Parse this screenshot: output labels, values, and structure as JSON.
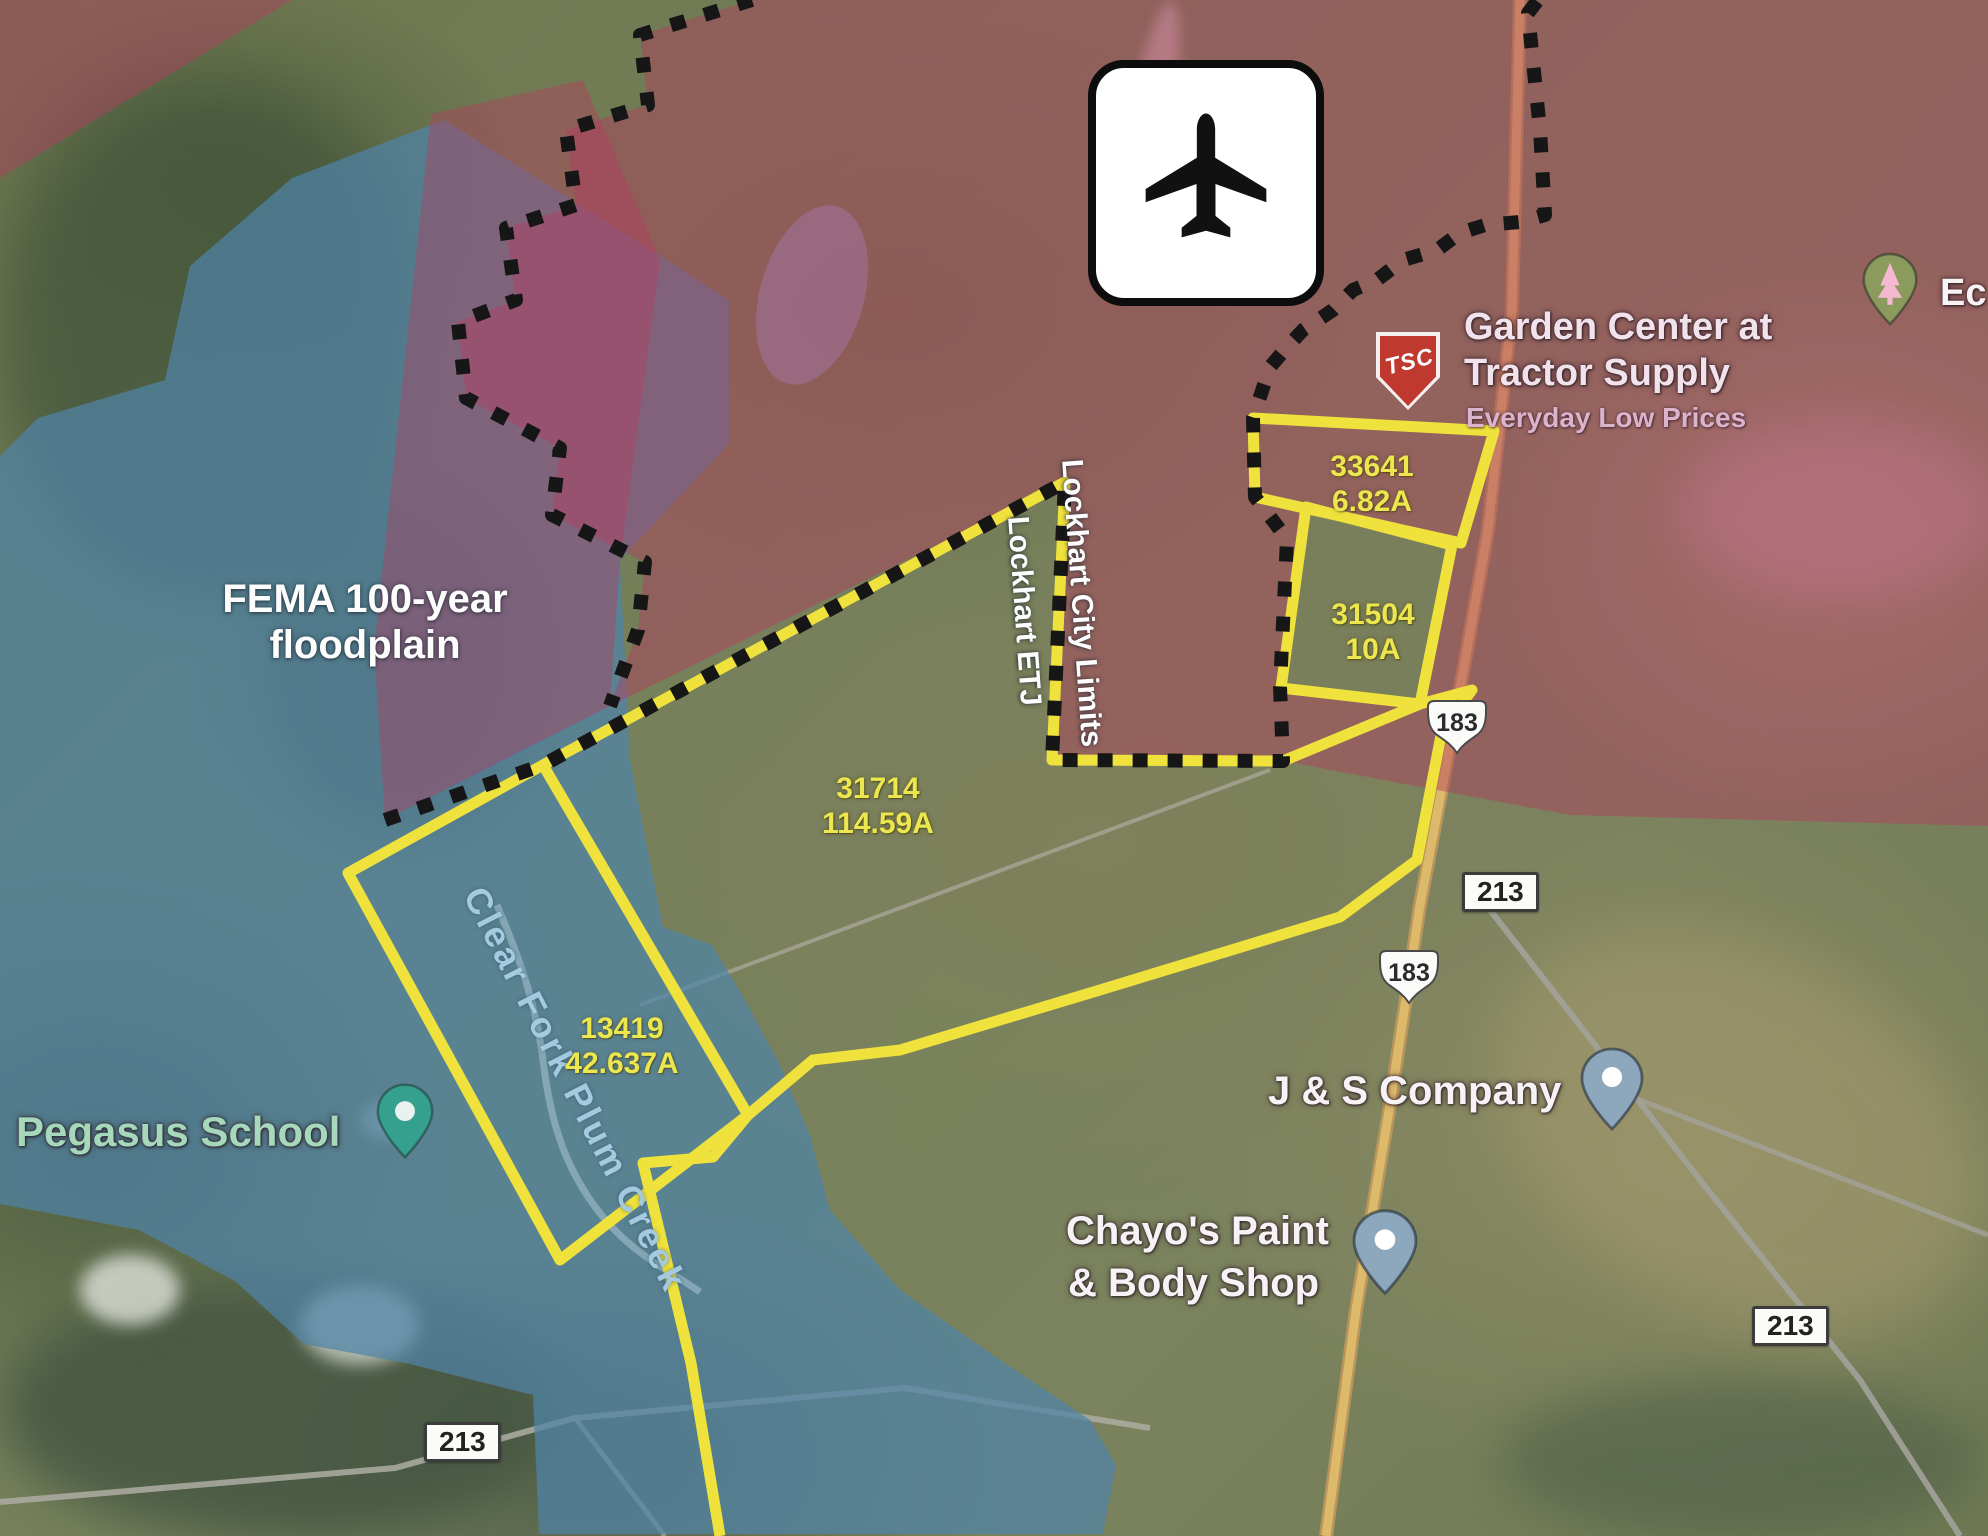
{
  "annotations": {
    "floodplain": {
      "line1": "FEMA 100-year",
      "line2": "floodplain"
    },
    "city_limits": "Lockhart City Limits",
    "etj": "Lockhart ETJ",
    "creek": "Clear Fork Plum Creek"
  },
  "parcels": [
    {
      "id": "33641",
      "acres": "6.82A"
    },
    {
      "id": "31504",
      "acres": "10A"
    },
    {
      "id": "31714",
      "acres": "114.59A"
    },
    {
      "id": "13419",
      "acres": "42.637A"
    }
  ],
  "pois": {
    "tractor_supply": {
      "line1": "Garden Center at",
      "line2": "Tractor Supply",
      "tagline": "Everyday Low Prices",
      "badge": "TSC"
    },
    "pegasus_school": "Pegasus School",
    "js_company": "J & S Company",
    "chayos": {
      "line1": "Chayo's Paint",
      "line2": "& Body Shop"
    },
    "edge_poi": "Ec"
  },
  "road_signs": {
    "us183": "183",
    "sr213": "213"
  },
  "colors": {
    "parcel_outline": "#f0e23c",
    "floodplain": "#4f83a8",
    "city_zone": "#b43c5f",
    "boundary_dash": "#161616",
    "highway": "#dcb96b"
  }
}
